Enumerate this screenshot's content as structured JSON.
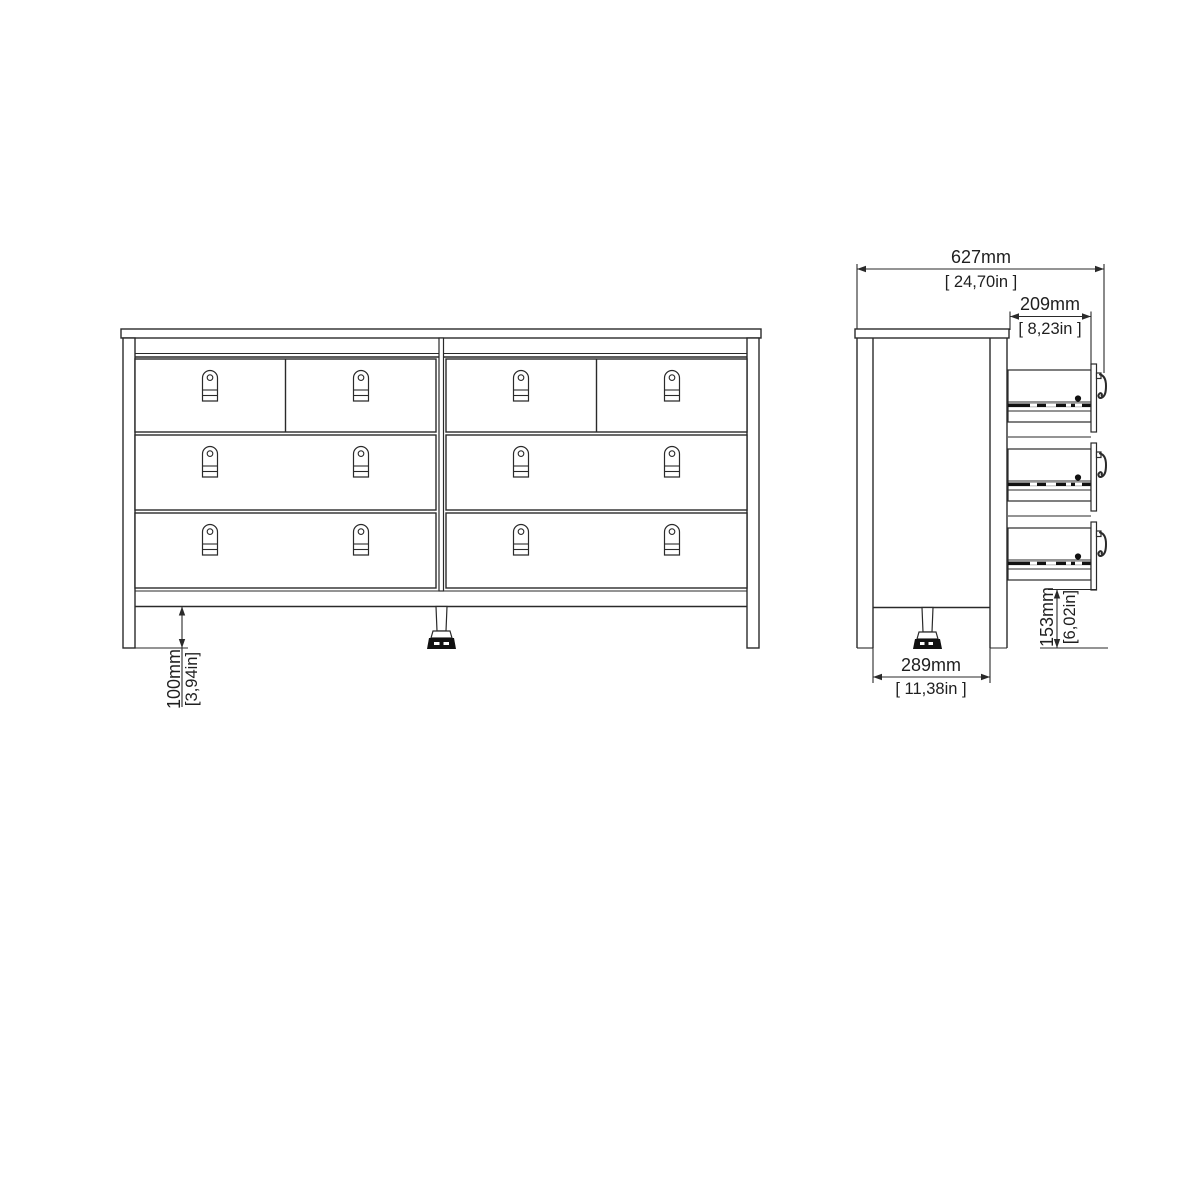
{
  "drawing": {
    "kind": "furniture dimensional diagram",
    "dims": {
      "leg_height": {
        "mm": "100mm",
        "in": "[3,94in]"
      },
      "total_depth": {
        "mm": "627mm",
        "in": "[ 24,70in ]"
      },
      "top_depth": {
        "mm": "209mm",
        "in": "[ 8,23in ]"
      },
      "base_depth": {
        "mm": "289mm",
        "in": "[ 11,38in ]"
      },
      "bottom_clearance": {
        "mm": "153mm",
        "in": "[6,02in]"
      }
    },
    "colors": {
      "background": "#ffffff",
      "line": "#2a2a2a",
      "text": "#1f1f1f",
      "solid_fill": "#111111"
    }
  }
}
